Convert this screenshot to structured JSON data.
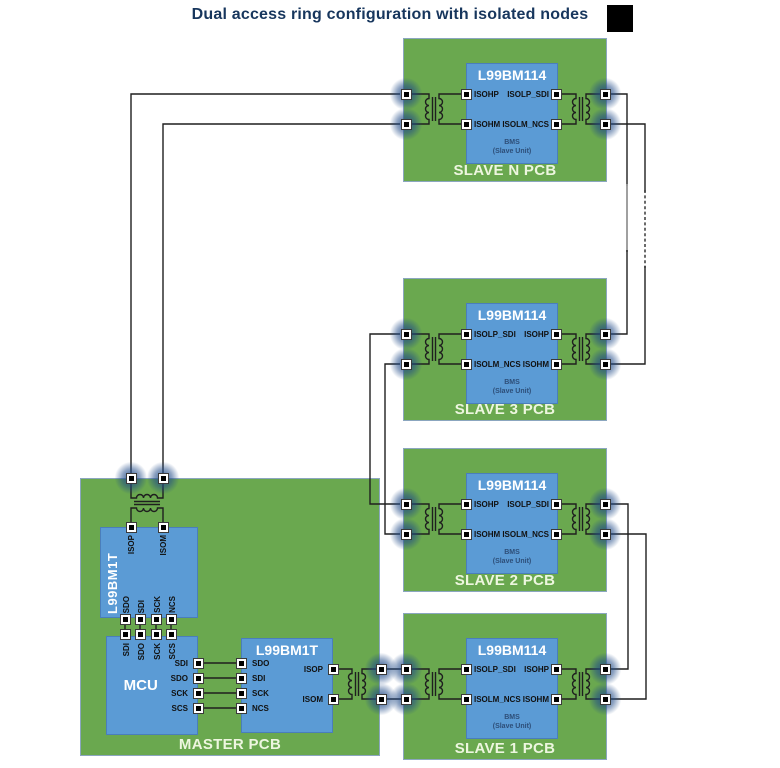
{
  "title": "Dual access ring configuration with isolated nodes",
  "colors": {
    "title_text": "#17365d",
    "pcb_green": "#6aa84f",
    "pcb_border": "#8ba6bf",
    "chip_blue": "#5b9bd5",
    "chip_border": "#4a7ebb",
    "board_label_text": "#edf6df",
    "bms_text": "#2d4e78",
    "wire": "#1f1f1f",
    "pad_glow": "#204a87",
    "marker": "#000000"
  },
  "shared": {
    "bms_line1": "BMS",
    "bms_line2": "(Slave Unit)"
  },
  "boards": {
    "slave_n": {
      "chip": "L99BM114",
      "label": "SLAVE N PCB",
      "pins": {
        "left": [
          "ISOHP",
          "ISOHM"
        ],
        "right": [
          "ISOLP_SDI",
          "ISOLM_NCS"
        ]
      }
    },
    "slave_3": {
      "chip": "L99BM114",
      "label": "SLAVE 3 PCB",
      "pins": {
        "left": [
          "ISOLP_SDI",
          "ISOLM_NCS"
        ],
        "right": [
          "ISOHP",
          "ISOHM"
        ]
      }
    },
    "slave_2": {
      "chip": "L99BM114",
      "label": "SLAVE 2 PCB",
      "pins": {
        "left": [
          "ISOHP",
          "ISOHM"
        ],
        "right": [
          "ISOLP_SDI",
          "ISOLM_NCS"
        ]
      }
    },
    "slave_1": {
      "chip": "L99BM114",
      "label": "SLAVE 1 PCB",
      "pins": {
        "left": [
          "ISOLP_SDI",
          "ISOLM_NCS"
        ],
        "right": [
          "ISOHP",
          "ISOHM"
        ]
      }
    },
    "master": {
      "label": "MASTER PCB",
      "v_chip": {
        "title": "L99BM1T",
        "pins_top": [
          "ISOP",
          "ISOM"
        ],
        "pins_bottom": [
          "SDO",
          "SDI",
          "SCK",
          "NCS"
        ]
      },
      "mcu": {
        "title": "MCU",
        "pins_top": [
          "SDI",
          "SDO",
          "SCK",
          "SCS"
        ],
        "pins_right": [
          "SDI",
          "SDO",
          "SCK",
          "SCS"
        ]
      },
      "h_chip": {
        "title": "L99BM1T",
        "pins_left": [
          "SDO",
          "SDI",
          "SCK",
          "NCS"
        ],
        "pins_right": [
          "ISOP",
          "ISOM"
        ]
      }
    }
  }
}
